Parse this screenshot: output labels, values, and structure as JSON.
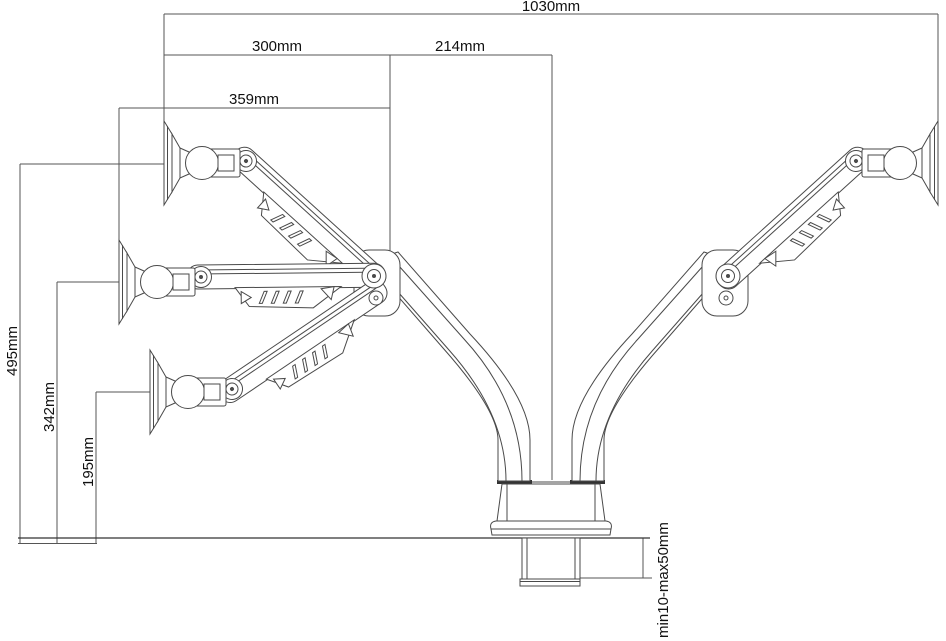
{
  "diagram": {
    "labels": {
      "total_width": "1030mm",
      "span_left": "300mm",
      "span_right": "214mm",
      "span_extension": "359mm",
      "height_high": "495mm",
      "height_mid": "342mm",
      "height_low": "195mm",
      "clamp_range": "min10-max50mm"
    }
  }
}
